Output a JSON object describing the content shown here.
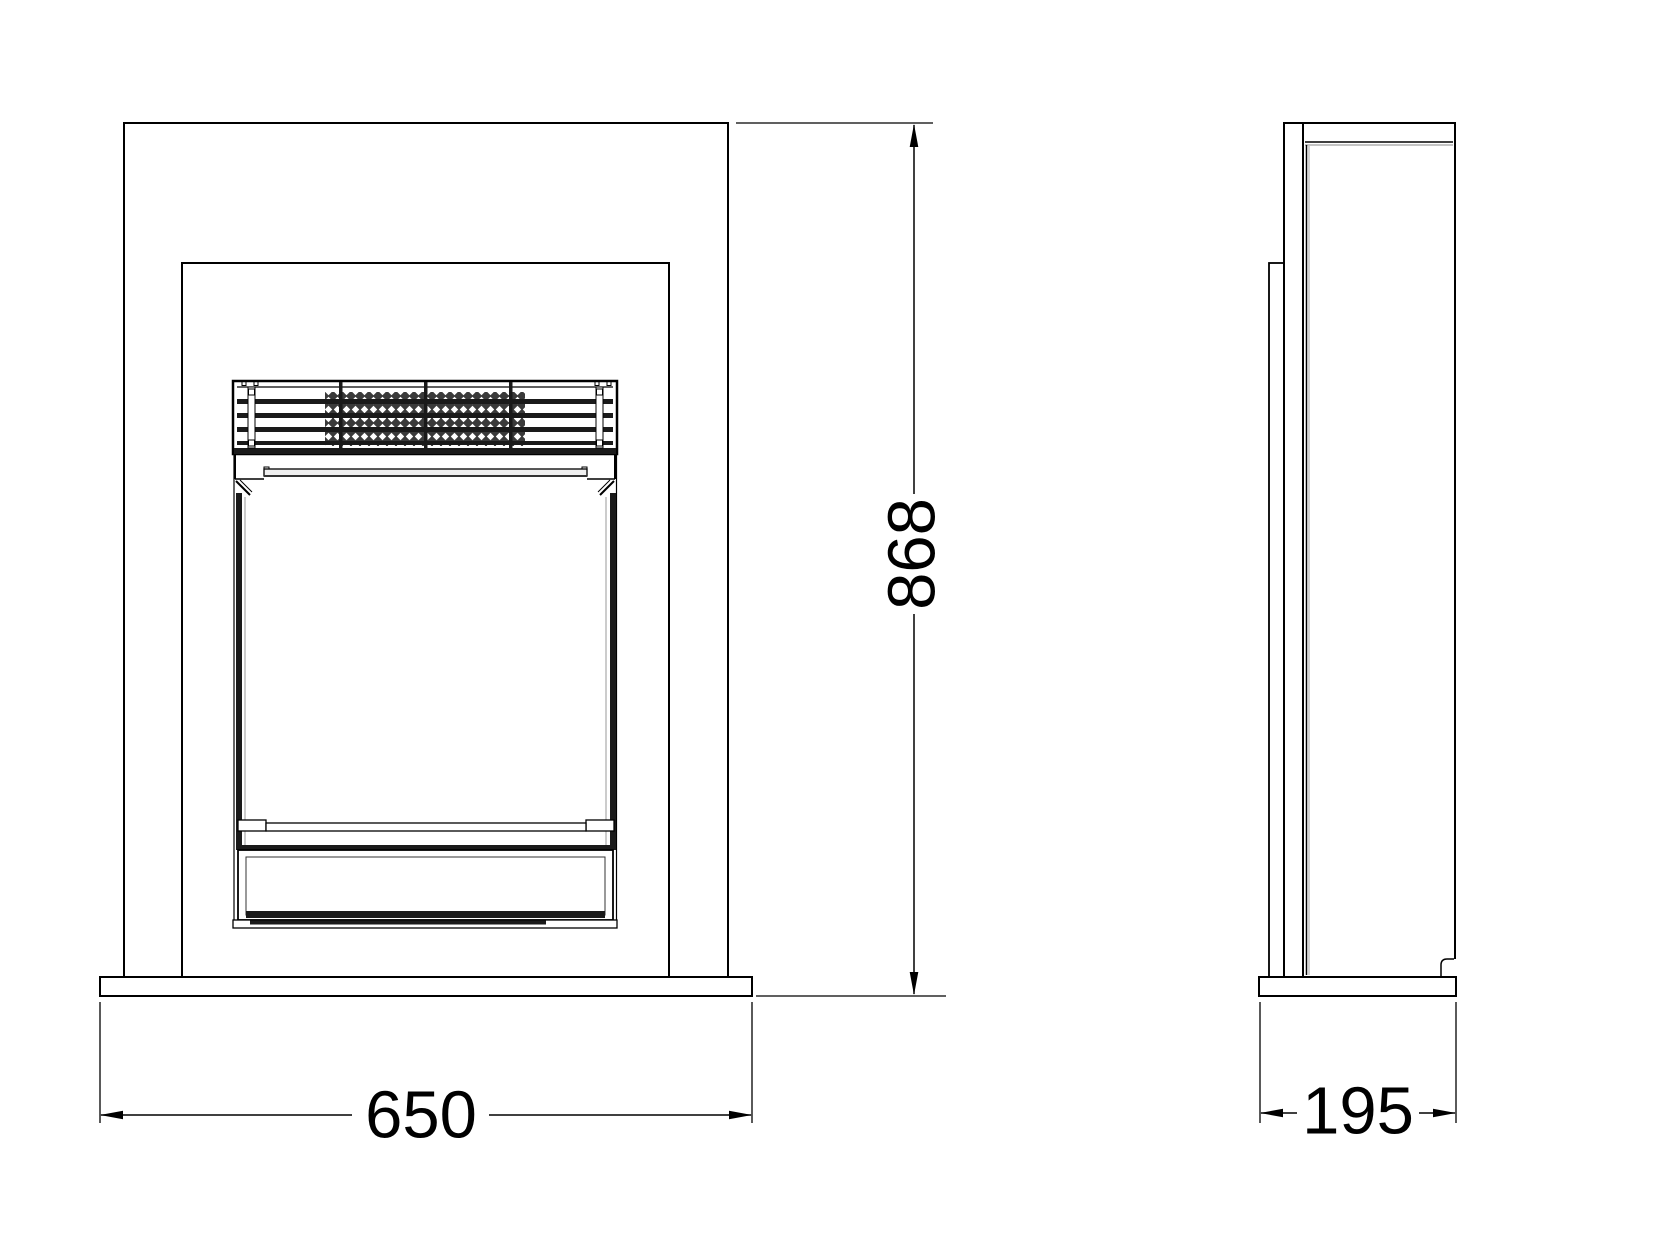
{
  "drawing": {
    "dimensions": {
      "height_mm": "868",
      "width_mm": "650",
      "depth_mm": "195"
    },
    "colors": {
      "background": "#ffffff",
      "line": "#000000",
      "dark_fill": "#1a1a1a",
      "trim_gray": "#f0f0f0"
    }
  }
}
